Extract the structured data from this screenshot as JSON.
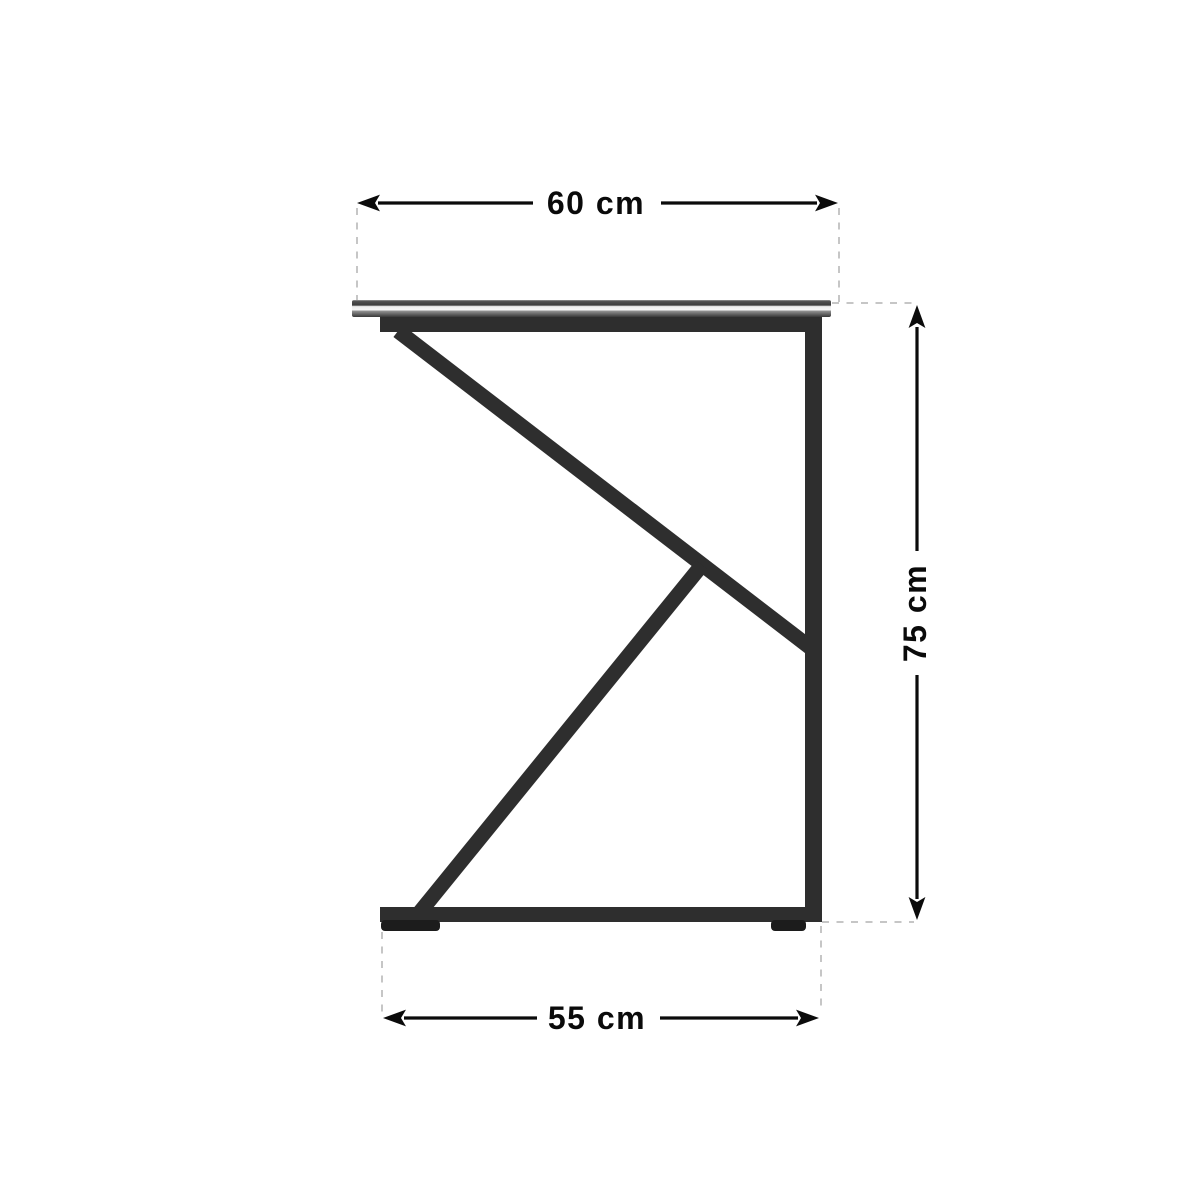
{
  "diagram": {
    "kind": "furniture-dimension-diagram",
    "subject": "z-frame side table, side view",
    "background": "#ffffff",
    "dimensions": {
      "width": {
        "label": "60 cm",
        "value": 60,
        "unit": "cm",
        "position": "top"
      },
      "height": {
        "label": "75 cm",
        "value": 75,
        "unit": "cm",
        "position": "right"
      },
      "depth": {
        "label": "55 cm",
        "value": 55,
        "unit": "cm",
        "position": "bottom"
      }
    },
    "colors": {
      "frame": "#2e2e2e",
      "feet": "#1c1c1c",
      "tabletop_edge_stripe": "#f2f2f2",
      "tabletop_dark": "#3c3c3c",
      "dimension_line": "#0b0b0b",
      "guide_line": "#c6c6c6",
      "label_text": "#0a0a0a"
    }
  }
}
